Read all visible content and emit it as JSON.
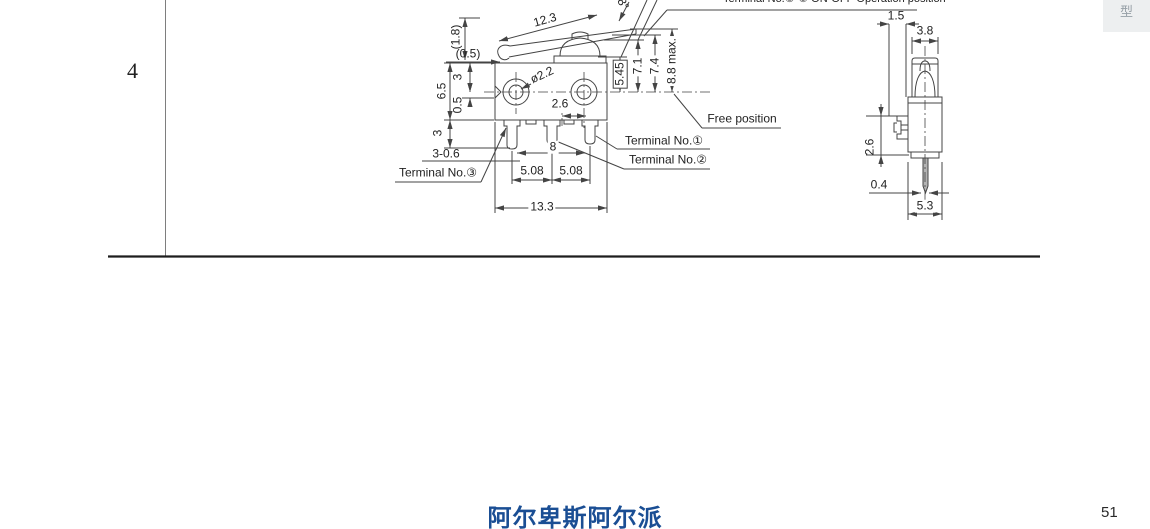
{
  "page": {
    "row_number": "4",
    "corner_tab_label": "型",
    "footer_brand": "阿尔卑斯阿尔派",
    "brand_color": "#1a4e94",
    "page_number": "51"
  },
  "front_view": {
    "top_note": "Terminal No.①-③ ON-OFF Operation position",
    "free_position_label": "Free position",
    "terminal1_label": "Terminal No.①",
    "terminal2_label": "Terminal No.②",
    "terminal3_label": "Terminal No.③",
    "dims": {
      "lever_length": "12.3",
      "lever_angle": "8°",
      "lever_end_height": "(1.8)",
      "lever_thickness": "(0.5)",
      "top_to_center": "3",
      "body_height": "6.5",
      "notch_depth": "0.5",
      "pin_length": "3",
      "pin_note": "3-0.6",
      "hole_diameter": "ø2.2",
      "hole_offset": "2.6",
      "pin_span": "8",
      "pitch_left": "5.08",
      "pitch_right": "5.08",
      "body_width": "13.3",
      "op_height": "5.45",
      "height_1": "7.1",
      "height_2": "7.4",
      "free_height": "8.8 max."
    }
  },
  "side_view": {
    "dims": {
      "clip_offset": "1.5",
      "plunger_width": "3.8",
      "clip_height": "2.6",
      "pin_thickness": "0.4",
      "body_depth": "5.3"
    }
  }
}
